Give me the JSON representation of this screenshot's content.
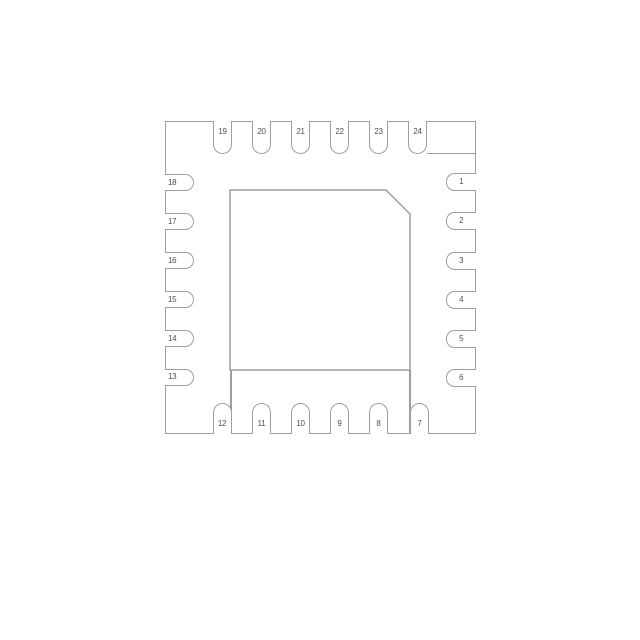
{
  "colors": {
    "bg-color": "#ffffff",
    "line-color": "#9e9e9e",
    "text-color": "#4f4f4f"
  },
  "pins": {
    "top": [
      "19",
      "20",
      "21",
      "22",
      "23",
      "24"
    ],
    "right": [
      "1",
      "2",
      "3",
      "4",
      "5",
      "6"
    ],
    "bottom": [
      "12",
      "11",
      "10",
      "9",
      "8",
      "7"
    ],
    "left": [
      "18",
      "17",
      "16",
      "15",
      "14",
      "13"
    ]
  }
}
